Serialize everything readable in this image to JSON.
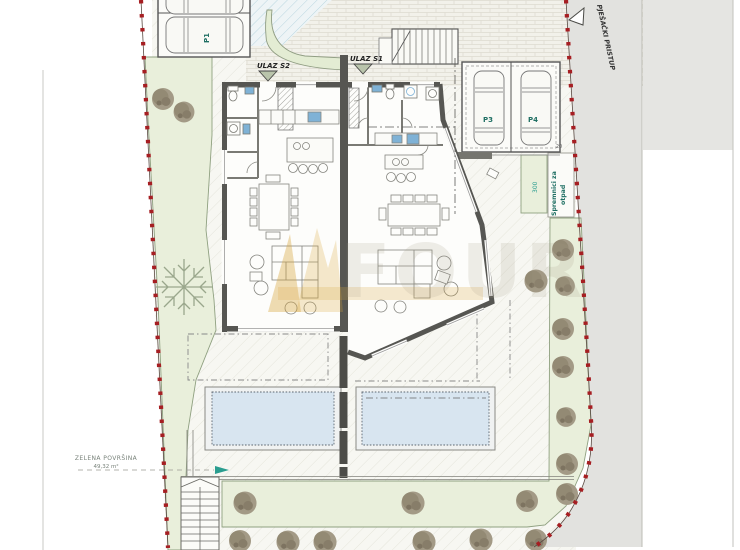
{
  "drawing": {
    "type": "architectural-site-plan",
    "labels": {
      "pedestrian_access": "PJEŠAČKI PRISTUP",
      "entrance_s1": "ULAZ S1",
      "entrance_s2": "ULAZ S2",
      "parking_p1": "P1",
      "parking_p3": "P3",
      "parking_p4": "P4",
      "green_area_title": "ZELENA POVRŠINA",
      "green_area_value": "49,32 m²",
      "waste_line1": "Spremnici za",
      "waste_line2": "otpad",
      "dim_300": "300",
      "dim_20": "20"
    },
    "watermark_text": "FOUR",
    "colors": {
      "boundary_red": "#8a1a1a",
      "marker_red": "#a61e22",
      "pale_green": "#e9efdb",
      "pool_blue": "#d8e5f0",
      "teal_accent": "#2a9d8f",
      "label_teal": "#1f6f63",
      "wall_gray": "#555555",
      "outside_gray": "#e2e2df",
      "fixture_blue": "#7fb2d6",
      "watermark_gold": "#d9a73e"
    }
  }
}
